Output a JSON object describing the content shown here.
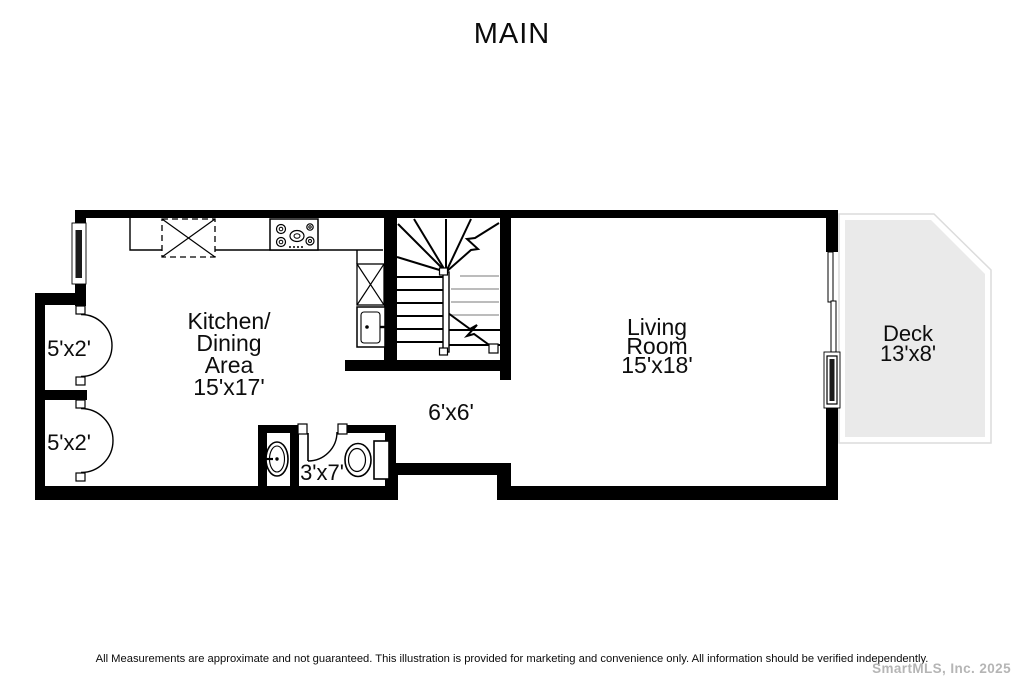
{
  "title": "MAIN",
  "rooms": {
    "kitchen": {
      "line1": "Kitchen/",
      "line2": "Dining",
      "line3": "Area",
      "dims": "15'x17'"
    },
    "living_room": {
      "line1": "Living",
      "line2": "Room",
      "dims": "15'x18'"
    },
    "deck": {
      "line1": "Deck",
      "dims": "13'x8'"
    },
    "hall": {
      "dims": "6'x6'"
    },
    "bathroom": {
      "dims": "3'x7'"
    },
    "closet_upper": {
      "dims": "5'x2'"
    },
    "closet_lower": {
      "dims": "5'x2'"
    }
  },
  "footer": {
    "disclaimer": "All Measurements are approximate and not guaranteed.  This illustration is provided for marketing and convenience only.  All information should be verified independently.",
    "watermark": "SmartMLS, Inc.  2025"
  },
  "colors": {
    "wall": "#000000",
    "deck_fill": "#eaeaea",
    "deck_outline": "#dcdcdc",
    "gray_tread": "#bcbcbc",
    "watermark_gray": "#b5b5b5"
  }
}
